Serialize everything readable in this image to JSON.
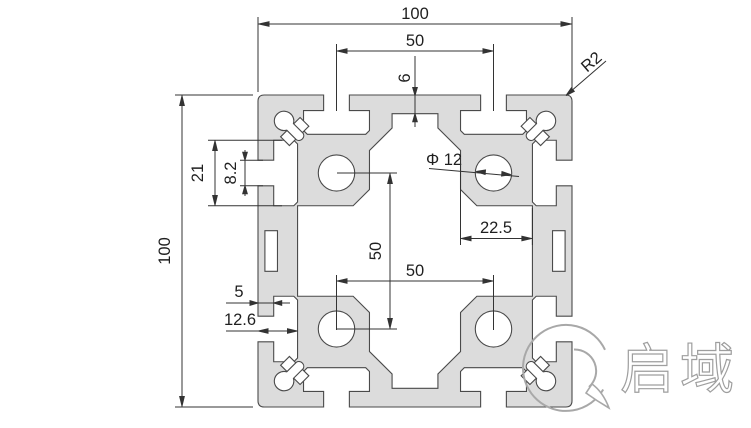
{
  "drawing": {
    "type": "aluminium-profile-cross-section",
    "dims": {
      "overall_width": "100",
      "overall_height": "100",
      "slot_spacing_top": "50",
      "hole_spacing_vertical": "50",
      "hole_spacing_horizontal": "50",
      "center_wall_thickness": "6",
      "corner_radius": "R2",
      "slot_cavity_width": "21",
      "slot_opening_width": "8.2",
      "hole_diameter": "Φ 12",
      "boss_to_surface": "22.5",
      "lip_depth": "5",
      "slot_depth": "12.6"
    },
    "watermark": {
      "brand_text": "启域"
    },
    "colors": {
      "profile_fill": "#dcdcdc",
      "profile_line": "#4a4a4a",
      "dimension_line": "#333333",
      "text": "#1f1f1f",
      "watermark": "#9e9e9e"
    }
  }
}
